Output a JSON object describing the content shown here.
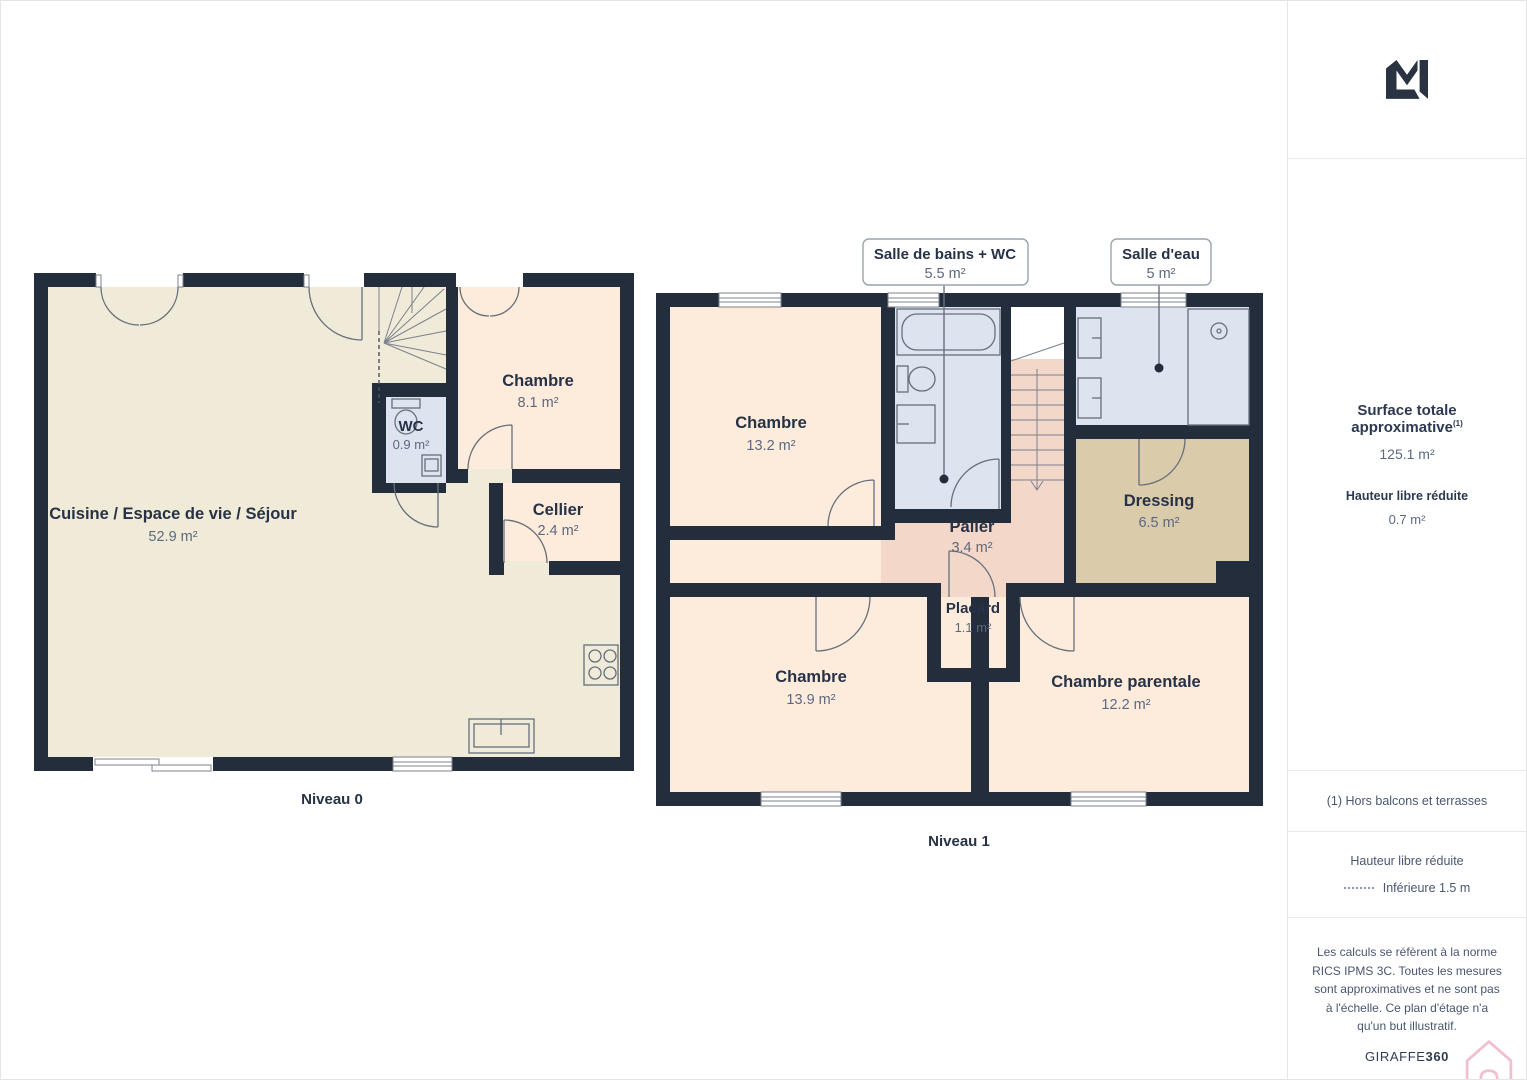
{
  "floors": [
    {
      "name": "Niveau 0",
      "rooms": [
        {
          "label": "Cuisine / Espace de vie / Séjour",
          "area": "52.9 m²"
        },
        {
          "label": "WC",
          "area": "0.9 m²"
        },
        {
          "label": "Chambre",
          "area": "8.1 m²"
        },
        {
          "label": "Cellier",
          "area": "2.4 m²"
        }
      ]
    },
    {
      "name": "Niveau 1",
      "rooms": [
        {
          "label": "Chambre",
          "area": "13.2 m²"
        },
        {
          "label": "Palier",
          "area": "3.4 m²"
        },
        {
          "label": "Dressing",
          "area": "6.5 m²"
        },
        {
          "label": "Placard",
          "area": "1.1 m²"
        },
        {
          "label": "Chambre",
          "area": "13.9 m²"
        },
        {
          "label": "Chambre parentale",
          "area": "12.2 m²"
        }
      ],
      "callouts": [
        {
          "label": "Salle de bains + WC",
          "area": "5.5 m²"
        },
        {
          "label": "Salle d'eau",
          "area": "5 m²"
        }
      ]
    }
  ],
  "sidebar": {
    "surface_title": "Surface totale approximative",
    "surface_sup": "(1)",
    "surface_value": "125.1 m²",
    "reduced_title": "Hauteur libre réduite",
    "reduced_value": "0.7 m²",
    "footnote": "(1) Hors balcons et terrasses",
    "legend_title": "Hauteur libre réduite",
    "legend_item": "Inférieure 1.5 m",
    "disclaimer": "Les calculs se réfèrent à la norme RICS IPMS 3C. Toutes les mesures sont approximatives et ne sont pas à l'échelle. Ce plan d'étage n'a qu'un but illustratif.",
    "brand_normal": "GIRAFFE",
    "brand_bold": "360"
  },
  "colors": {
    "wall": "#232d3b",
    "floor_living": "#f0ebd8",
    "floor_bedroom": "#fdecdc",
    "floor_landing": "#f3d7c8",
    "floor_bath": "#dee3f0",
    "floor_dressing": "#dacbaa",
    "floor_closet": "#d2d3d6",
    "text_dark": "#273247",
    "text_muted": "#5d6880",
    "brand_pink": "#f0c0cd"
  }
}
